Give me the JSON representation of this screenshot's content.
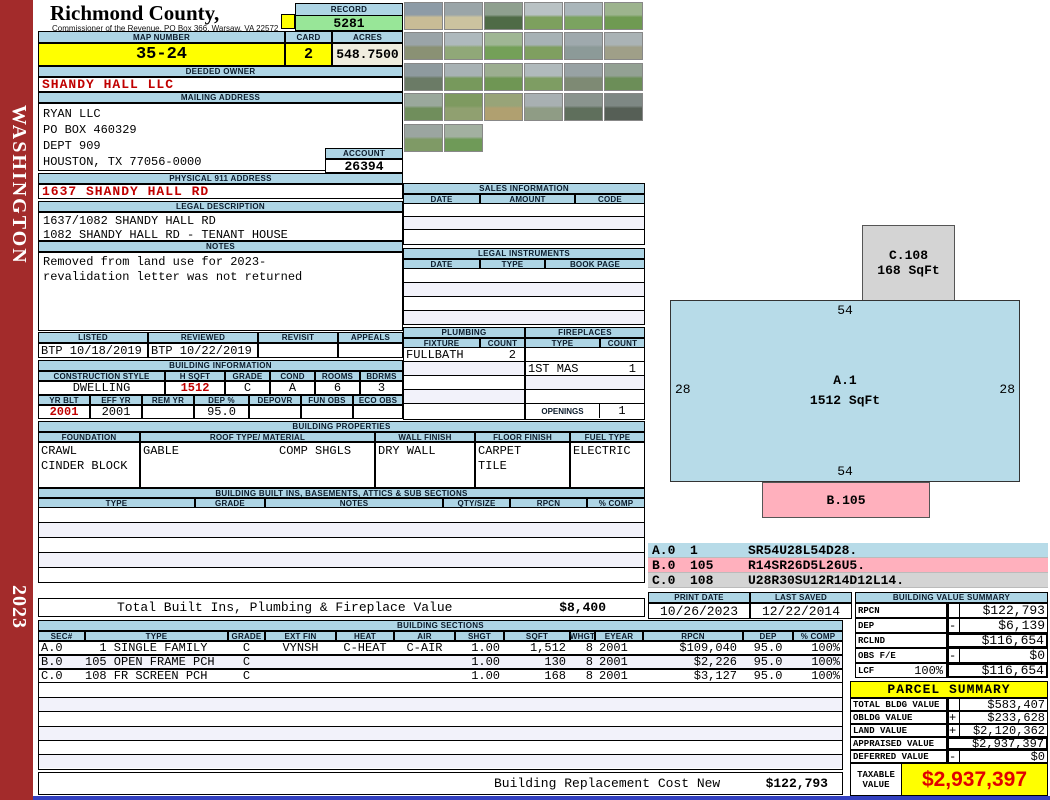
{
  "sidebar": {
    "region": "WASHINGTON",
    "year": "2023"
  },
  "header": {
    "county": "Richmond County, Virginia",
    "office": "Commissioner of the Revenue, PO Box 366, Warsaw, VA 22572",
    "record_label": "RECORD",
    "record_number": "5281",
    "map_label": "MAP NUMBER",
    "map_number": "35-24",
    "card_label": "CARD",
    "card_number": "2",
    "acres_label": "ACRES",
    "acres": "548.7500"
  },
  "owner": {
    "label": "DEEDED OWNER",
    "name": "SHANDY HALL LLC"
  },
  "mailing": {
    "label": "MAILING ADDRESS",
    "line1": "RYAN LLC",
    "line2": "PO BOX 460329",
    "line3": "DEPT 909",
    "line4": "HOUSTON, TX 77056-0000"
  },
  "account": {
    "label": "ACCOUNT",
    "number": "26394"
  },
  "physical": {
    "label": "PHYSICAL 911 ADDRESS",
    "address": "1637 SHANDY HALL RD"
  },
  "legal_description": {
    "label": "LEGAL DESCRIPTION",
    "line1": "1637/1082 SHANDY HALL RD",
    "line2": "1082 SHANDY HALL RD - TENANT HOUSE"
  },
  "notes": {
    "label": "NOTES",
    "line1": "Removed from land use for 2023-",
    "line2": "revalidation letter was not returned"
  },
  "review": {
    "listed_label": "LISTED",
    "listed": "BTP 10/18/2019",
    "reviewed_label": "REVIEWED",
    "reviewed": "BTP 10/22/2019",
    "revisit_label": "REVISIT",
    "revisit": "",
    "appeals_label": "APPEALS",
    "appeals": ""
  },
  "building_information": {
    "label": "BUILDING INFORMATION",
    "style_label": "CONSTRUCTION STYLE",
    "style": "DWELLING",
    "hsqft_label": "H SQFT",
    "hsqft": "1512",
    "grade_label": "GRADE",
    "grade": "C",
    "cond_label": "COND",
    "cond": "A",
    "rooms_label": "ROOMS",
    "rooms": "6",
    "bdrms_label": "BDRMS",
    "bdrms": "3",
    "yrblt_label": "YR BLT",
    "yrblt": "2001",
    "effyr_label": "EFF YR",
    "effyr": "2001",
    "remyr_label": "REM YR",
    "remyr": "",
    "dep_label": "DEP %",
    "dep": "95.0",
    "depovr_label": "DEPOVR",
    "depovr": "",
    "funobs_label": "FUN OBS",
    "funobs": "",
    "ecoobs_label": "ECO OBS",
    "ecoobs": ""
  },
  "building_properties": {
    "label": "BUILDING PROPERTIES",
    "foundation_label": "FOUNDATION",
    "foundation_line1": "CRAWL",
    "foundation_line2": "CINDER BLOCK",
    "roof_label": "ROOF TYPE/ MATERIAL",
    "roof_type": "GABLE",
    "roof_material": "COMP SHGLS",
    "wall_label": "WALL FINISH",
    "wall_finish": "DRY WALL",
    "floor_label": "FLOOR FINISH",
    "floor_line1": "CARPET",
    "floor_line2": "TILE",
    "fuel_label": "FUEL TYPE",
    "fuel_type": "ELECTRIC"
  },
  "built_ins": {
    "label": "BUILDING BUILT INS, BASEMENTS, ATTICS & SUB SECTIONS",
    "headers": [
      "TYPE",
      "GRADE",
      "NOTES",
      "QTY/SIZE",
      "RPCN",
      "% COMP"
    ]
  },
  "totals": {
    "built_ins_label": "Total Built Ins, Plumbing & Fireplace Value",
    "built_ins_value": "$8,400",
    "replacement_label": "Building Replacement Cost New",
    "replacement_value": "$122,793"
  },
  "sales": {
    "label": "SALES INFORMATION",
    "headers": [
      "DATE",
      "AMOUNT",
      "CODE"
    ]
  },
  "legal_instruments": {
    "label": "LEGAL INSTRUMENTS",
    "headers": [
      "DATE",
      "TYPE",
      "BOOK PAGE"
    ]
  },
  "plumbing": {
    "label": "PLUMBING",
    "fixture_label": "FIXTURE",
    "count_label": "COUNT",
    "fixture1": "FULLBATH",
    "count1": "2"
  },
  "fireplaces": {
    "label": "FIREPLACES",
    "type_label": "TYPE",
    "count_label": "COUNT",
    "type1": "1ST MAS",
    "count1": "1",
    "openings_label": "OPENINGS",
    "openings_count": "1"
  },
  "sketch": {
    "c_id": "C.108",
    "c_sqft": "168 SqFt",
    "a_id": "A.1",
    "a_sqft": "1512 SqFt",
    "a_dim_top": "54",
    "a_dim_bottom": "54",
    "a_dim_left": "28",
    "a_dim_right": "28",
    "b_id": "B.105",
    "legend": [
      {
        "section": "A.0",
        "number": "1",
        "path": "SR54U28L54D28."
      },
      {
        "section": "B.0",
        "number": "105",
        "path": "R14SR26D5L26U5."
      },
      {
        "section": "C.0",
        "number": "108",
        "path": "U28R30SU12R14D12L14."
      }
    ],
    "colors": {
      "a": "#B7DBE8",
      "b": "#FFB0BD",
      "c": "#D4D4D4"
    }
  },
  "print_info": {
    "print_date_label": "PRINT DATE",
    "print_date": "10/26/2023",
    "last_saved_label": "LAST SAVED",
    "last_saved": "12/22/2014"
  },
  "building_value_summary": {
    "label": "BUILDING VALUE SUMMARY",
    "rows": [
      {
        "label": "RPCN",
        "pct": "",
        "sign": "",
        "value": "$122,793"
      },
      {
        "label": "DEP",
        "pct": "",
        "sign": "-",
        "value": "$6,139"
      },
      {
        "label": "RCLND",
        "pct": "",
        "sign": "",
        "value": "$116,654"
      },
      {
        "label": "OBS F/E",
        "pct": "",
        "sign": "-",
        "value": "$0"
      },
      {
        "label": "LCF",
        "pct": "100%",
        "sign": "",
        "value": "$116,654"
      }
    ]
  },
  "building_sections": {
    "label": "BUILDING SECTIONS",
    "headers": [
      "SEC#",
      "TYPE",
      "GRADE",
      "EXT FIN",
      "HEAT",
      "AIR",
      "SHGT",
      "SQFT",
      "WHGT",
      "EYEAR",
      "RPCN",
      "DEP",
      "% COMP"
    ],
    "rows": [
      {
        "sec": "A.0",
        "type": "  1 SINGLE FAMILY",
        "grade": "C",
        "ext_fin": "VYNSH",
        "heat": "C-HEAT",
        "air": "C-AIR",
        "shgt": "1.00",
        "sqft": "1,512",
        "whgt": "8",
        "eyear": "2001",
        "rpcn": "$109,040",
        "dep": "95.0",
        "comp": "100%"
      },
      {
        "sec": "B.0",
        "type": "105 OPEN FRAME PCH",
        "grade": "C",
        "ext_fin": "",
        "heat": "",
        "air": "",
        "shgt": "1.00",
        "sqft": "130",
        "whgt": "8",
        "eyear": "2001",
        "rpcn": "$2,226",
        "dep": "95.0",
        "comp": "100%"
      },
      {
        "sec": "C.0",
        "type": "108 FR SCREEN PCH",
        "grade": "C",
        "ext_fin": "",
        "heat": "",
        "air": "",
        "shgt": "1.00",
        "sqft": "168",
        "whgt": "8",
        "eyear": "2001",
        "rpcn": "$3,127",
        "dep": "95.0",
        "comp": "100%"
      }
    ]
  },
  "parcel_summary": {
    "label": "PARCEL SUMMARY",
    "rows": [
      {
        "label": "TOTAL BLDG VALUE",
        "sign": "",
        "value": "$583,407"
      },
      {
        "label": "OBLDG VALUE",
        "sign": "+",
        "value": "$233,628"
      },
      {
        "label": "LAND VALUE",
        "sign": "+",
        "value": "$2,120,362"
      },
      {
        "label": "APPRAISED VALUE",
        "sign": "",
        "value": "$2,937,397"
      },
      {
        "label": "DEFERRED VALUE",
        "sign": "-",
        "value": "$0"
      }
    ],
    "taxable_label": "TAXABLE VALUE",
    "taxable_value": "$2,937,397"
  },
  "photos": [
    {
      "c1": "#8d9ba6",
      "c2": "#c8bc96"
    },
    {
      "c1": "#9aa5a8",
      "c2": "#cbc39f"
    },
    {
      "c1": "#8fa08f",
      "c2": "#4f6b46"
    },
    {
      "c1": "#b9c2c4",
      "c2": "#7da05e"
    },
    {
      "c1": "#aab6ba",
      "c2": "#7ba360"
    },
    {
      "c1": "#9db48e",
      "c2": "#6f9a52"
    },
    {
      "c1": "#9aa4a8",
      "c2": "#8a9174"
    },
    {
      "c1": "#aeb9bd",
      "c2": "#90a878"
    },
    {
      "c1": "#9fb694",
      "c2": "#74a058"
    },
    {
      "c1": "#a7b2b5",
      "c2": "#7f9f60"
    },
    {
      "c1": "#9fa9ad",
      "c2": "#8c9a98"
    },
    {
      "c1": "#aab3b5",
      "c2": "#9f9f88"
    },
    {
      "c1": "#8e9a9e",
      "c2": "#6b7b66"
    },
    {
      "c1": "#a8b2b4",
      "c2": "#77995c"
    },
    {
      "c1": "#9cae90",
      "c2": "#6f9654"
    },
    {
      "c1": "#b0babc",
      "c2": "#7e9d63"
    },
    {
      "c1": "#98a2a4",
      "c2": "#7e8a74"
    },
    {
      "c1": "#93a193",
      "c2": "#6c8e58"
    },
    {
      "c1": "#9aa89c",
      "c2": "#708e5c"
    },
    {
      "c1": "#7e9a60",
      "c2": "#90a070"
    },
    {
      "c1": "#98a478",
      "c2": "#b0a070"
    },
    {
      "c1": "#a8b0b2",
      "c2": "#8f9c85"
    },
    {
      "c1": "#8a948e",
      "c2": "#5f6f5c"
    },
    {
      "c1": "#7e8884",
      "c2": "#565f56"
    },
    {
      "c1": "#9ba5a0",
      "c2": "#7f9a66"
    },
    {
      "c1": "#a2b0a0",
      "c2": "#6f9a58"
    }
  ]
}
